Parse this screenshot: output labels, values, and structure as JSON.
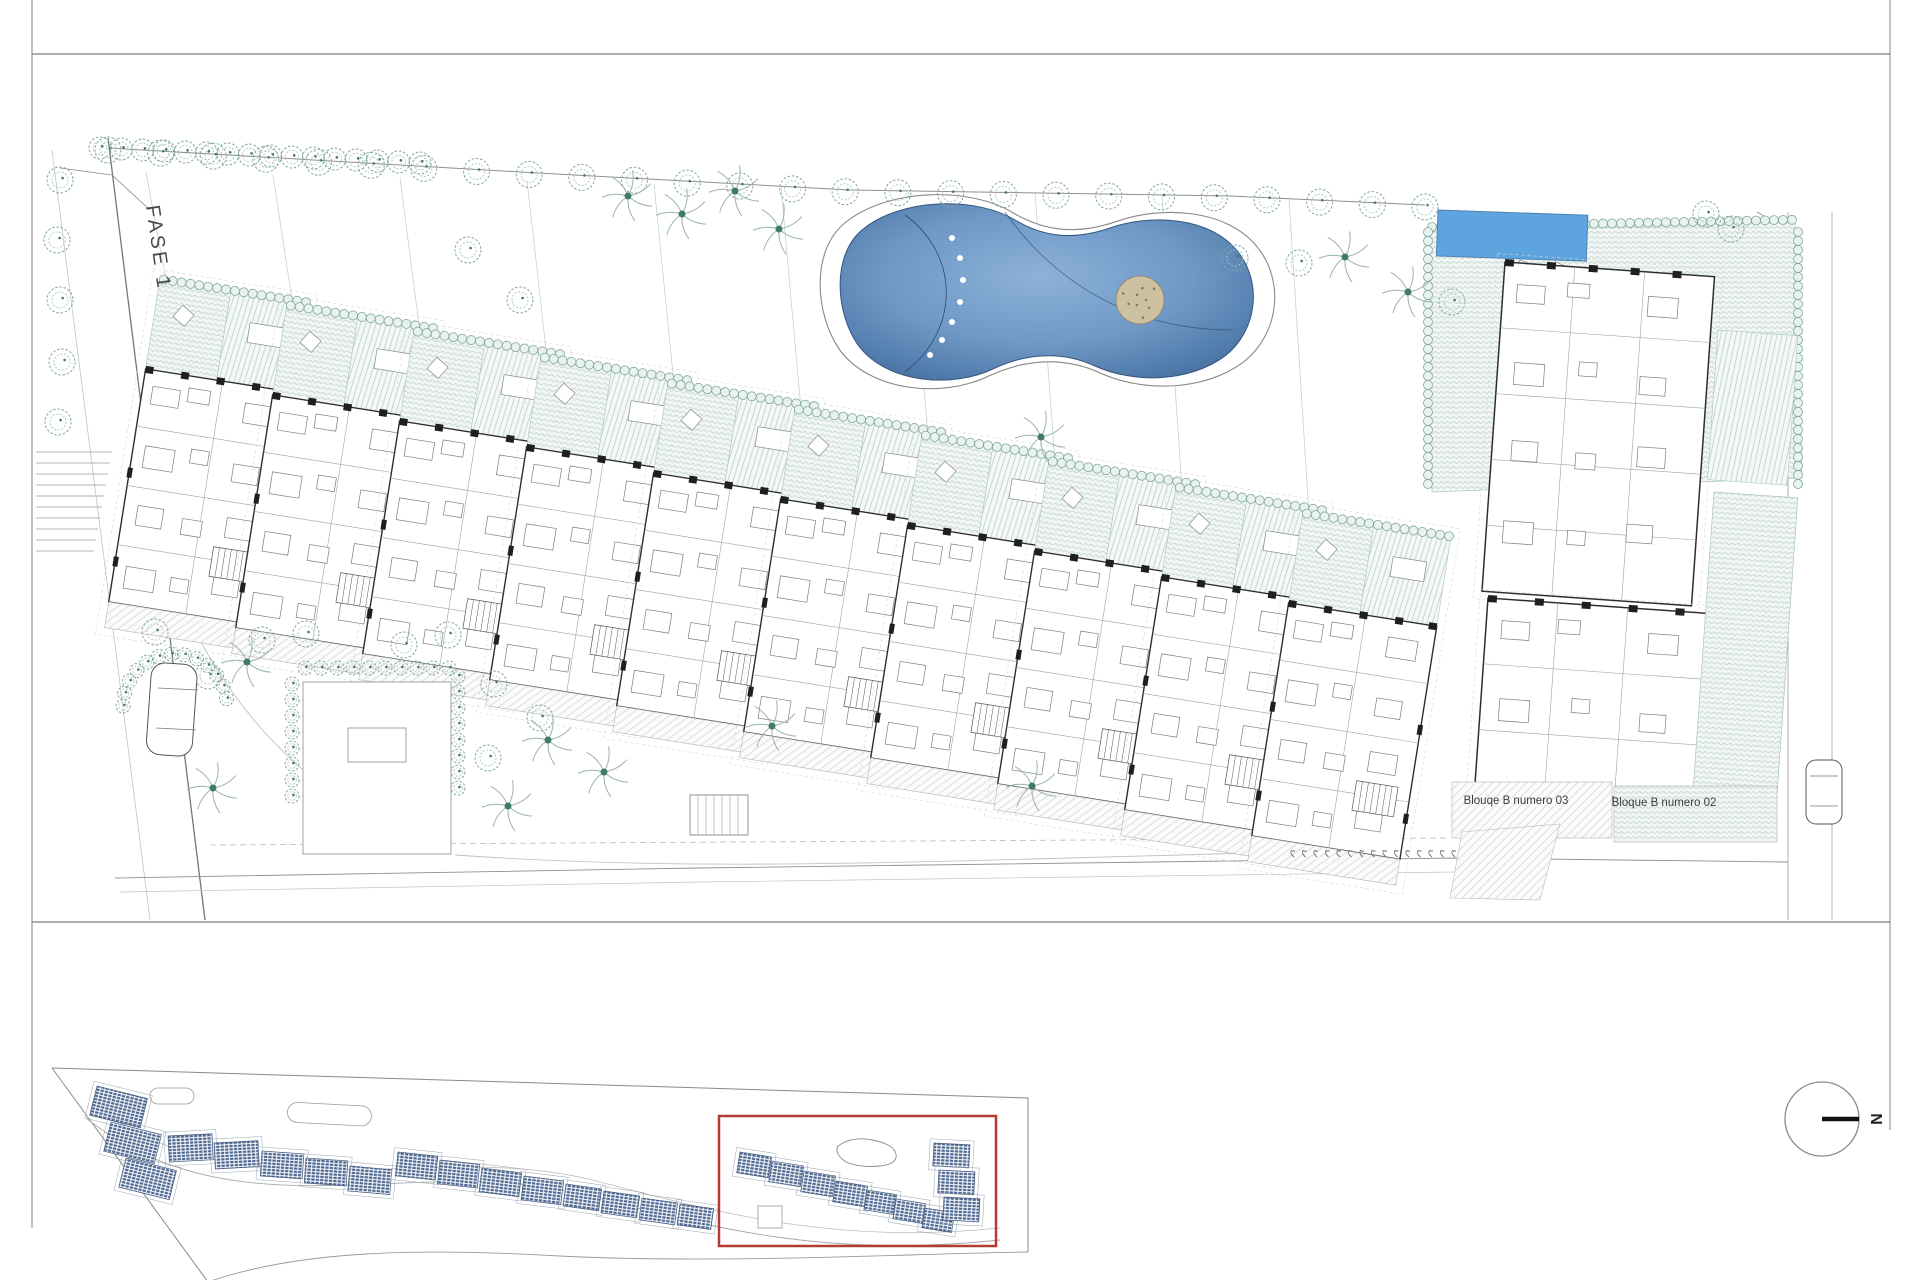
{
  "labels": {
    "phase": "FASE 1",
    "block_03": "Blouqe B numero 03",
    "block_02": "Bloque B numero 02",
    "north": "N"
  },
  "colors": {
    "veg": "#7fa79f",
    "veg_dark": "#417a6c",
    "veg_light": "#a9c6c0",
    "hatch_line": "#b9cfc9",
    "hatch_bg": "#f1f6f5",
    "wall": "#2e2e2e",
    "line": "#8f8f8f",
    "line_light": "#c2c2c2",
    "pool_deep": "#45709f",
    "pool_mid": "#6f98c6",
    "pool_light": "#8db2d8",
    "lap_pool": "#5ea4de",
    "island": "#cdc19f",
    "roof_blue": "#4b6691",
    "highlight": "#b23b32",
    "text": "#3c3c3c"
  },
  "drawing": {
    "buildings": {
      "shared": {
        "w": 150,
        "garden_h": 92,
        "body_h": 236,
        "terrace_h": 26,
        "rot": 9
      },
      "items": [
        {
          "x": 160,
          "y": 278
        },
        {
          "x": 287,
          "y": 304
        },
        {
          "x": 414,
          "y": 330
        },
        {
          "x": 541,
          "y": 356
        },
        {
          "x": 668,
          "y": 382
        },
        {
          "x": 795,
          "y": 408
        },
        {
          "x": 922,
          "y": 434
        },
        {
          "x": 1049,
          "y": 460
        },
        {
          "x": 1176,
          "y": 486
        },
        {
          "x": 1303,
          "y": 512
        }
      ]
    },
    "right_complex": {
      "deck": [
        [
          1425,
          232
        ],
        [
          1795,
          222
        ],
        [
          1802,
          478
        ],
        [
          1432,
          492
        ]
      ],
      "lap_pool": {
        "x": 1438,
        "y": 210,
        "w": 150,
        "h": 46,
        "rot": 2
      },
      "main_building": {
        "x": 1505,
        "y": 262,
        "w": 210,
        "h": 330,
        "rot": 4
      },
      "lower_building": {
        "x": 1488,
        "y": 598,
        "w": 235,
        "h": 190,
        "rot": 4
      },
      "side_garden": {
        "x": 1714,
        "y": 492,
        "w": 84,
        "h": 296,
        "rot": 4
      },
      "terrace_03": {
        "x": 1452,
        "y": 782,
        "w": 160,
        "h": 56
      },
      "terrace_02": {
        "x": 1614,
        "y": 786,
        "w": 163,
        "h": 56
      },
      "road_x1": 1788,
      "road_x2": 1832
    },
    "pool": {
      "cx": 1040,
      "cy": 295,
      "island": {
        "cx": 1140,
        "cy": 300,
        "r": 24
      }
    },
    "top_trees": {
      "points": [
        [
          108,
          148
        ],
        [
          520,
          172
        ],
        [
          850,
          190
        ],
        [
          1230,
          196
        ],
        [
          1425,
          205
        ]
      ],
      "count": 26,
      "hedge_from": [
        100,
        148
      ],
      "hedge_to": [
        420,
        163
      ],
      "hedge_count": 16
    },
    "trees": [
      [
        60,
        180
      ],
      [
        57,
        240
      ],
      [
        60,
        300
      ],
      [
        62,
        362
      ],
      [
        58,
        422
      ],
      [
        468,
        250
      ],
      [
        520,
        300
      ],
      [
        155,
        632
      ],
      [
        208,
        676
      ],
      [
        262,
        640
      ],
      [
        306,
        634
      ],
      [
        404,
        645
      ],
      [
        448,
        635
      ],
      [
        494,
        684
      ],
      [
        540,
        718
      ],
      [
        488,
        758
      ],
      [
        1235,
        258
      ],
      [
        1299,
        263
      ],
      [
        1452,
        302
      ],
      [
        1706,
        214
      ],
      [
        1731,
        229
      ]
    ],
    "palms": [
      [
        628,
        196
      ],
      [
        682,
        214
      ],
      [
        735,
        191
      ],
      [
        779,
        229
      ],
      [
        1345,
        257
      ],
      [
        1408,
        292
      ],
      [
        1041,
        437
      ],
      [
        213,
        788
      ],
      [
        508,
        806
      ],
      [
        548,
        740
      ],
      [
        604,
        772
      ],
      [
        772,
        726
      ],
      [
        1032,
        786
      ],
      [
        247,
        662
      ]
    ],
    "parking_ticks": {
      "x": 1292,
      "y": 850,
      "count": 15,
      "step": 11.5
    },
    "labels_pos": {
      "block_03": {
        "x": 1516,
        "y": 804
      },
      "block_02": {
        "x": 1664,
        "y": 806
      },
      "phase": {
        "x": 146,
        "y": 206,
        "rot": 82
      }
    },
    "key_plan": {
      "highlight": {
        "x": 719,
        "y": 1116,
        "w": 277,
        "h": 130
      },
      "blocks": [
        [
          97,
          1086,
          52,
          30,
          14
        ],
        [
          111,
          1122,
          52,
          30,
          14
        ],
        [
          126,
          1158,
          52,
          30,
          14
        ],
        [
          168,
          1136,
          44,
          26,
          -3
        ],
        [
          214,
          1143,
          44,
          26,
          -3
        ],
        [
          262,
          1151,
          42,
          25,
          4
        ],
        [
          306,
          1158,
          42,
          25,
          4
        ],
        [
          350,
          1166,
          42,
          25,
          5
        ],
        [
          398,
          1152,
          40,
          24,
          6
        ],
        [
          440,
          1160,
          40,
          24,
          6
        ],
        [
          482,
          1168,
          40,
          24,
          7
        ],
        [
          524,
          1176,
          40,
          24,
          7
        ],
        [
          566,
          1184,
          36,
          22,
          8
        ],
        [
          604,
          1191,
          36,
          22,
          8
        ],
        [
          642,
          1198,
          36,
          22,
          8
        ],
        [
          680,
          1204,
          34,
          21,
          8
        ],
        [
          740,
          1152,
          32,
          21,
          9
        ],
        [
          772,
          1161,
          32,
          21,
          9
        ],
        [
          804,
          1171,
          32,
          21,
          9
        ],
        [
          836,
          1181,
          32,
          21,
          9
        ],
        [
          867,
          1190,
          30,
          20,
          9
        ],
        [
          896,
          1199,
          30,
          20,
          9
        ],
        [
          925,
          1208,
          30,
          20,
          9
        ],
        [
          934,
          1143,
          36,
          23,
          3
        ],
        [
          939,
          1170,
          36,
          23,
          3
        ],
        [
          944,
          1197,
          36,
          23,
          3
        ]
      ]
    },
    "north": {
      "cx": 1822,
      "cy": 1119,
      "r": 37
    }
  }
}
